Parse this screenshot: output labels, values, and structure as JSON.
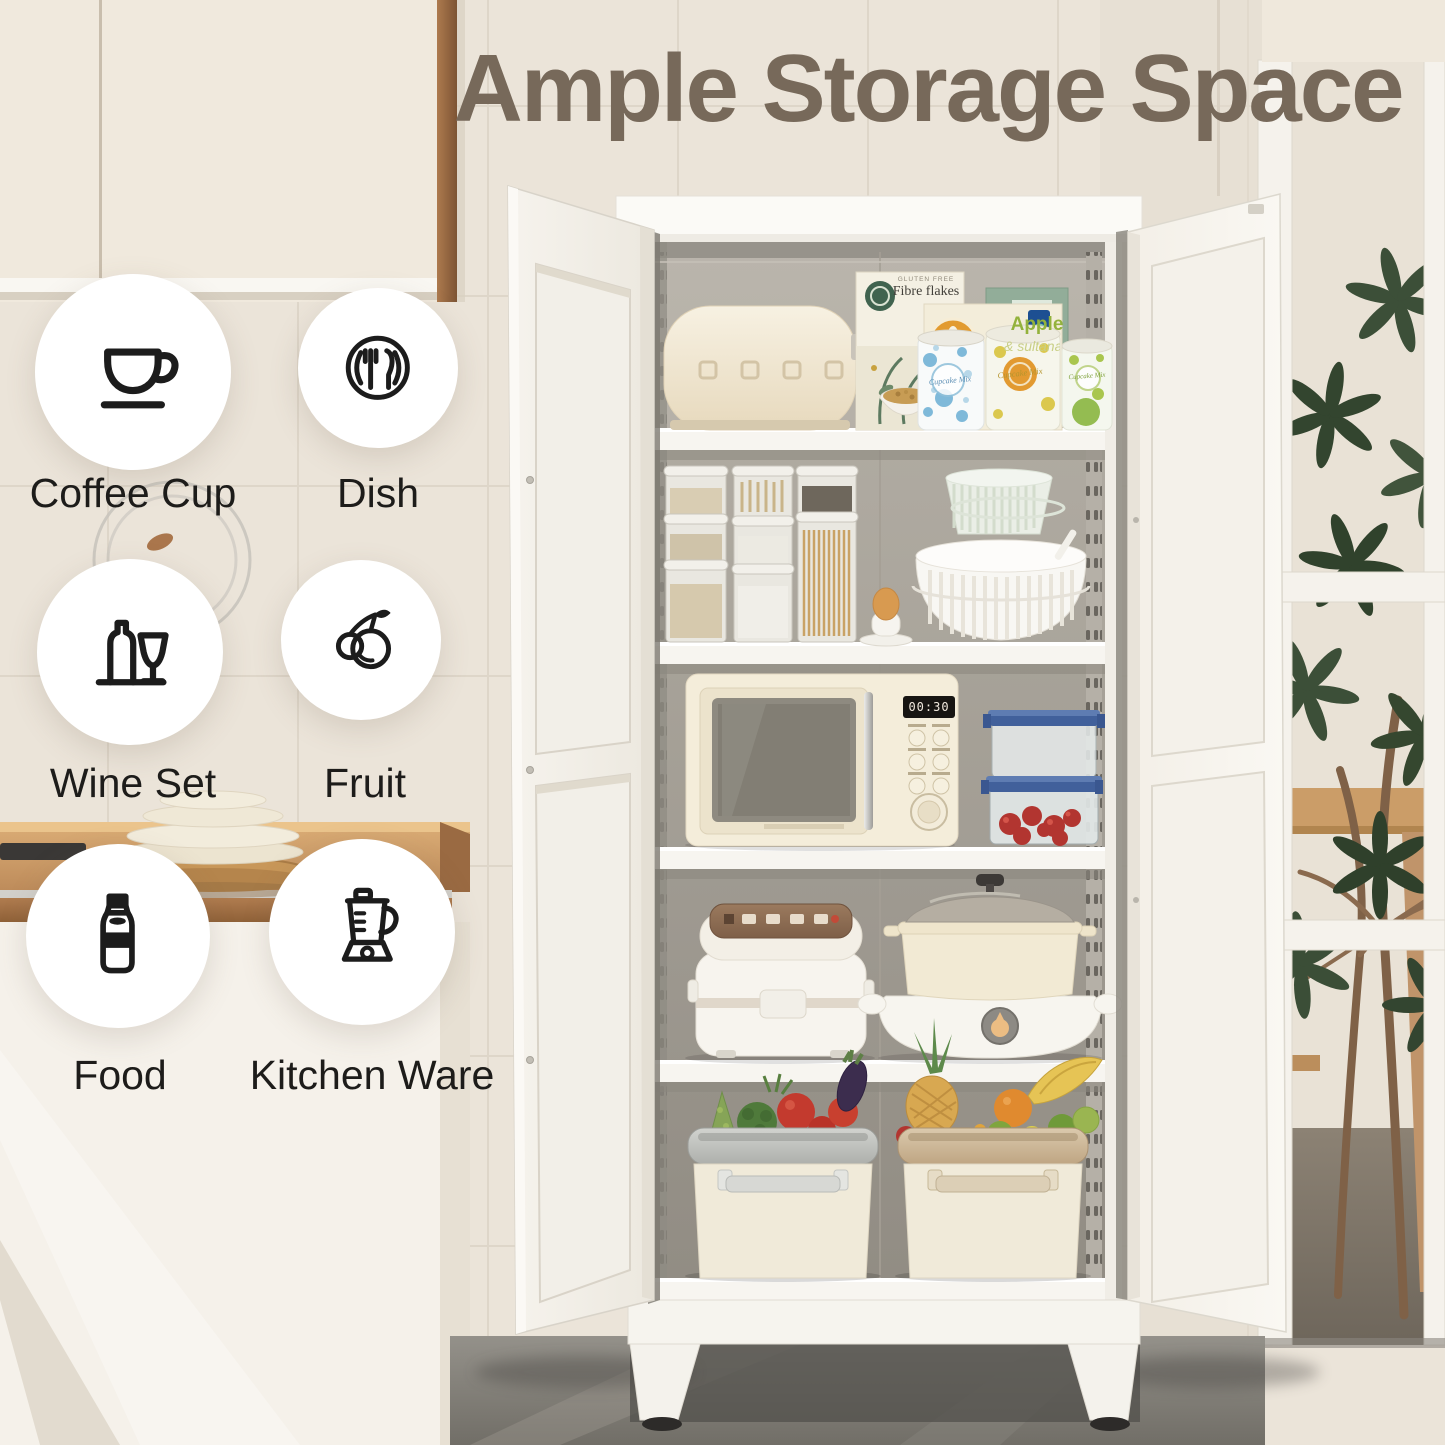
{
  "title": "Ample Storage Space",
  "features": [
    {
      "label": "Coffee Cup",
      "icon": "coffee-cup-icon"
    },
    {
      "label": "Dish",
      "icon": "dish-icon"
    },
    {
      "label": "Wine Set",
      "icon": "wine-set-icon"
    },
    {
      "label": "Fruit",
      "icon": "fruit-icon"
    },
    {
      "label": "Food",
      "icon": "food-bottle-icon"
    },
    {
      "label": "Kitchen Ware",
      "icon": "blender-icon"
    }
  ],
  "pantry_items": {
    "cereal_box": {
      "tag": "GLUTEN FREE",
      "name": "Fibre flakes"
    },
    "mix_box": {
      "line1": "Apple",
      "line2": "& sultana"
    },
    "can_label": "Cupcake Mix",
    "microwave_display": "00:30"
  },
  "colors": {
    "title_text": "#77695a",
    "badge_background": "#ffffff",
    "icon_stroke": "#1c1c1c",
    "wall_tile": "#ebe4d9",
    "counter_wood": "#c08a58",
    "cabinet_white": "#f4f1ea",
    "cabinet_interior": "#b0aba2",
    "floor_concrete": "#7b7872",
    "plant_leaf": "#3c4f38"
  }
}
